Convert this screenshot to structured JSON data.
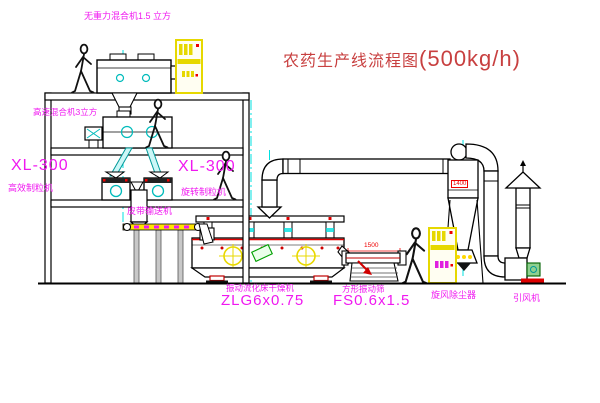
{
  "title": {
    "text_zh": "农药生产线流程图",
    "capacity": "(500kg/h)"
  },
  "equipment_labels": {
    "mixer_top": "无重力混合机1.5 立方",
    "mixer_floor2": "高速混合机3立方",
    "granulator_left": {
      "model": "XL-300",
      "name": "高效制粒机"
    },
    "granulator_mid": {
      "model": "XL-300",
      "name": "旋转制粒机"
    },
    "belt_conveyor": "皮带输送机",
    "fluid_bed_dryer": {
      "name": "振动流化床干燥机",
      "model": "ZLG6x0.75"
    },
    "vibrating_screen": {
      "name": "方形振动筛",
      "model": "FS0.6x1.5"
    },
    "cyclone": "旋风除尘器",
    "induced_draft_fan": "引风机"
  },
  "dimensions": {
    "screen_length": "1500",
    "cyclone_marker": "1400"
  },
  "colors": {
    "label_magenta": "#f018f0",
    "title_red": "#c84040",
    "dimension_red": "#ee0000",
    "centerline_cyan": "#00e0e0",
    "cabinet_yellow": "#e6d800",
    "belt_yellow": "#ffe400",
    "line_black": "#000000"
  }
}
